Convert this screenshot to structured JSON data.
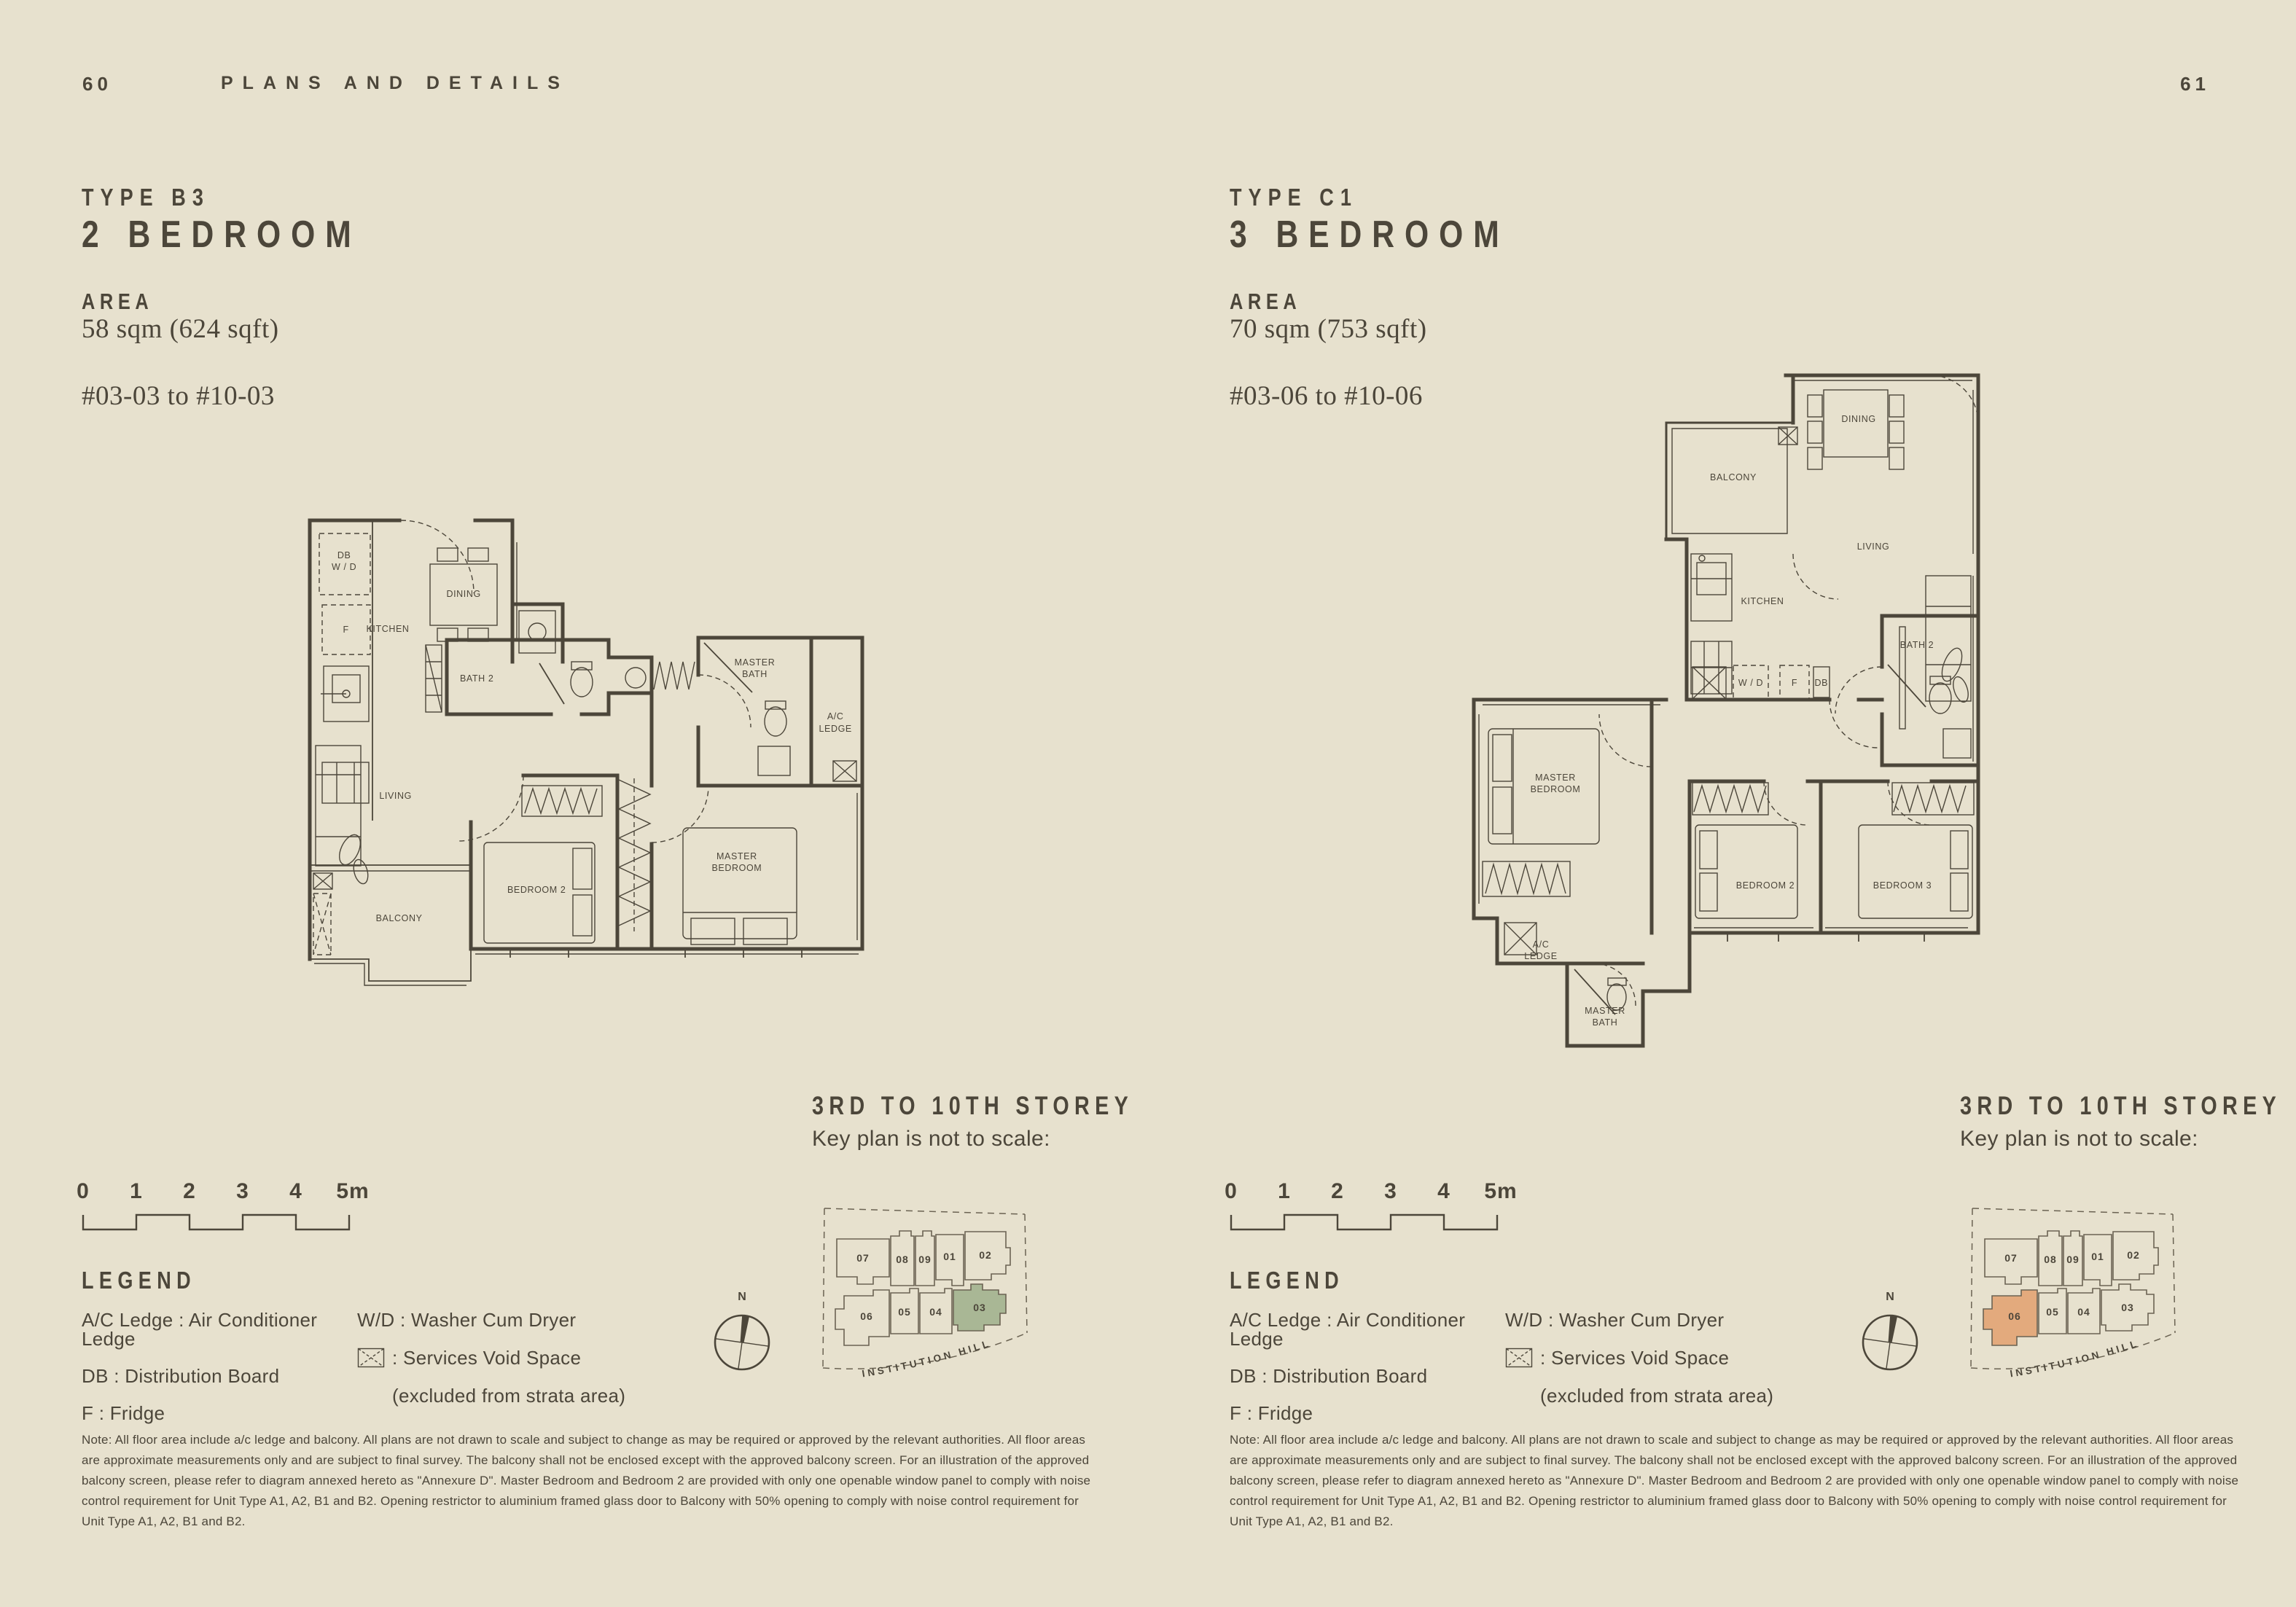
{
  "colors": {
    "background": "#e7e1ce",
    "ink": "#4c463a",
    "plan_line": "#4c463a",
    "keyplan_line": "#6b6353",
    "highlight_green": "#a9b795",
    "highlight_orange": "#e3aa7d"
  },
  "header": {
    "left_page_number": "60",
    "title": "PLANS AND DETAILS",
    "right_page_number": "61"
  },
  "pages": [
    {
      "type_label": "TYPE B3",
      "title": "2 BEDROOM",
      "area_label": "AREA",
      "area_value": "58 sqm (624 sqft)",
      "units_range": "#03-03 to #10-03",
      "storey_title": "3RD TO 10TH STOREY",
      "keyplan_caption": "Key plan is not to scale:",
      "highlighted_unit": "03",
      "rooms": {
        "db_wd": "DB\nW / D",
        "f": "F",
        "kitchen": "KITCHEN",
        "dining": "DINING",
        "bath2": "BATH 2",
        "master_bath": "MASTER\nBATH",
        "ac_ledge": "A/C\nLEDGE",
        "living": "LIVING",
        "bedroom2": "BEDROOM 2",
        "master_bedroom": "MASTER\nBEDROOM",
        "balcony": "BALCONY"
      }
    },
    {
      "type_label": "TYPE C1",
      "title": "3 BEDROOM",
      "area_label": "AREA",
      "area_value": "70 sqm (753 sqft)",
      "units_range": "#03-06 to #10-06",
      "storey_title": "3RD TO 10TH STOREY",
      "keyplan_caption": "Key plan is not to scale:",
      "highlighted_unit": "06",
      "rooms": {
        "balcony": "BALCONY",
        "dining": "DINING",
        "living": "LIVING",
        "kitchen": "KITCHEN",
        "bath2": "BATH 2",
        "wd": "W / D",
        "f": "F",
        "db": "DB",
        "master_bedroom": "MASTER\nBEDROOM",
        "bedroom2": "BEDROOM 2",
        "bedroom3": "BEDROOM 3",
        "ac_ledge": "A/C\nLEDGE",
        "master_bath": "MASTER\nBATH"
      }
    }
  ],
  "key_plan": {
    "units": [
      "07",
      "08",
      "09",
      "01",
      "02",
      "06",
      "05",
      "04",
      "03"
    ],
    "road_label": "INSTITUTION HILL",
    "compass_label": "N"
  },
  "scale_bar": {
    "ticks": [
      "0",
      "1",
      "2",
      "3",
      "4",
      "5m"
    ]
  },
  "legend": {
    "title": "LEGEND",
    "ac": "A/C Ledge : Air Conditioner Ledge",
    "db": "DB : Distribution Board",
    "f": "F : Fridge",
    "wd": "W/D : Washer Cum Dryer",
    "void_label": ": Services Void Space",
    "void_note": "(excluded from strata area)"
  },
  "note": "Note: All floor area include a/c ledge and balcony. All plans are not drawn to scale and subject to change as may be required or approved by the relevant authorities. All floor areas are approximate measurements only and are subject to final survey. The balcony shall not be enclosed except with the approved balcony screen. For an illustration of the approved balcony screen, please refer to diagram annexed hereto as \"Annexure D\". Master Bedroom and Bedroom 2 are provided with only one openable window panel to comply with noise control requirement for Unit Type A1, A2, B1 and B2. Opening restrictor to aluminium framed glass door to Balcony with 50% opening to comply with noise control requirement for Unit Type A1, A2, B1 and B2."
}
